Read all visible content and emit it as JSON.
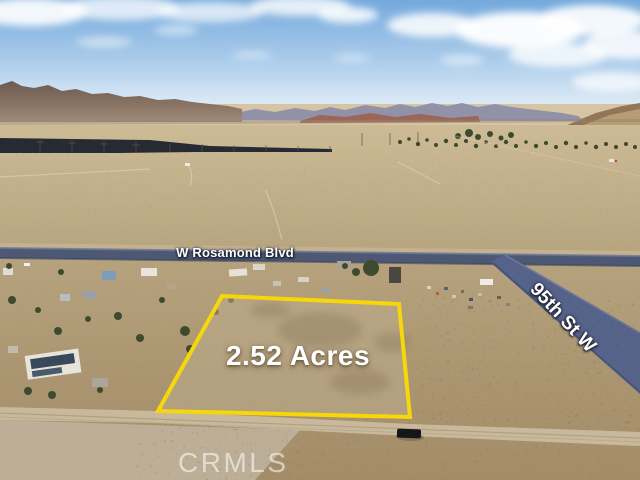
{
  "labels": {
    "road_horizontal": "W Rosamond Blvd",
    "road_diagonal": "95th St W",
    "acreage": "2.52 Acres",
    "watermark": "CRMLS"
  },
  "parcel": {
    "acres": 2.52
  },
  "colors": {
    "parcel_outline": "#f6d70a",
    "label_text": "#ffffff",
    "watermark_text": "rgba(255,255,255,0.55)",
    "sky_top": "#74a9dc",
    "sky_horizon": "#eff4f9",
    "paved_road": "#4c5874",
    "desert_light": "#c9b793",
    "desert_dark": "#9e8a66"
  }
}
